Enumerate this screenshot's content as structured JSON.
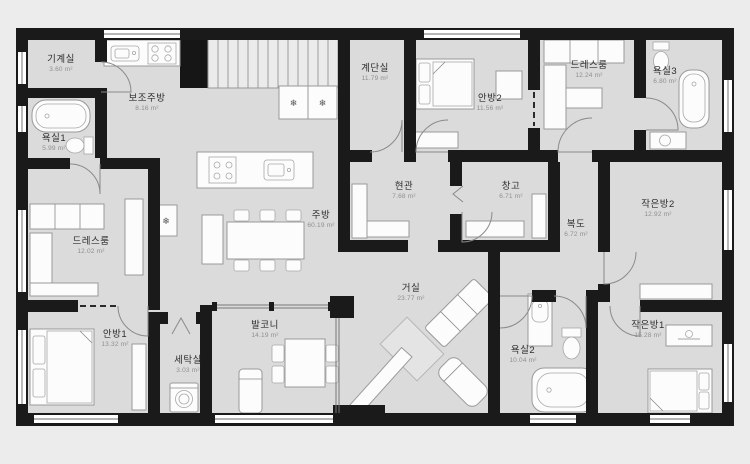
{
  "colors": {
    "background": "#ececec",
    "floor": "#dbdbdb",
    "wall": "#1a1a1a",
    "furniture_stroke": "#9a9a9a",
    "room_name_text": "#2e2e2e",
    "room_area_text": "#8f8f8f"
  },
  "icons": {
    "snowflake": "❄"
  },
  "plan": {
    "rooms": [
      {
        "id": "machine-room",
        "name": "기계실",
        "area": "3.60 m²",
        "x": 61,
        "y": 64
      },
      {
        "id": "sub-kitchen",
        "name": "보조주방",
        "area": "8.16 m²",
        "x": 147,
        "y": 103
      },
      {
        "id": "stair-hall",
        "name": "계단실",
        "area": "11.79 m²",
        "x": 375,
        "y": 73
      },
      {
        "id": "master-bedroom-2",
        "name": "안방2",
        "area": "11.56 m²",
        "x": 490,
        "y": 103
      },
      {
        "id": "dressroom-upper",
        "name": "드레스룸",
        "area": "12.24 m²",
        "x": 589,
        "y": 70
      },
      {
        "id": "bathroom-3",
        "name": "욕실3",
        "area": "6.80 m²",
        "x": 665,
        "y": 76
      },
      {
        "id": "bathroom-1",
        "name": "욕실1",
        "area": "5.99 m²",
        "x": 54,
        "y": 143
      },
      {
        "id": "entrance-hall",
        "name": "현관",
        "area": "7.68 m²",
        "x": 404,
        "y": 191
      },
      {
        "id": "storage",
        "name": "창고",
        "area": "6.71 m²",
        "x": 511,
        "y": 191
      },
      {
        "id": "kitchen",
        "name": "주방",
        "area": "60.19 m²",
        "x": 321,
        "y": 220
      },
      {
        "id": "small-room-2",
        "name": "작은방2",
        "area": "12.92 m²",
        "x": 658,
        "y": 209
      },
      {
        "id": "hallway",
        "name": "복도",
        "area": "6.72 m²",
        "x": 576,
        "y": 229
      },
      {
        "id": "dressroom-lower",
        "name": "드레스룸",
        "area": "12.02 m²",
        "x": 91,
        "y": 246
      },
      {
        "id": "living-room",
        "name": "거실",
        "area": "23.77 m²",
        "x": 411,
        "y": 293
      },
      {
        "id": "master-bedroom-1",
        "name": "안방1",
        "area": "13.32 m²",
        "x": 115,
        "y": 339
      },
      {
        "id": "laundry",
        "name": "세탁실",
        "area": "3.03 m²",
        "x": 188,
        "y": 365
      },
      {
        "id": "balcony",
        "name": "발코니",
        "area": "14.19 m²",
        "x": 265,
        "y": 330
      },
      {
        "id": "bathroom-2",
        "name": "욕실2",
        "area": "10.04 m²",
        "x": 523,
        "y": 355
      },
      {
        "id": "small-room-1",
        "name": "작은방1",
        "area": "15.28 m²",
        "x": 648,
        "y": 330
      }
    ]
  }
}
